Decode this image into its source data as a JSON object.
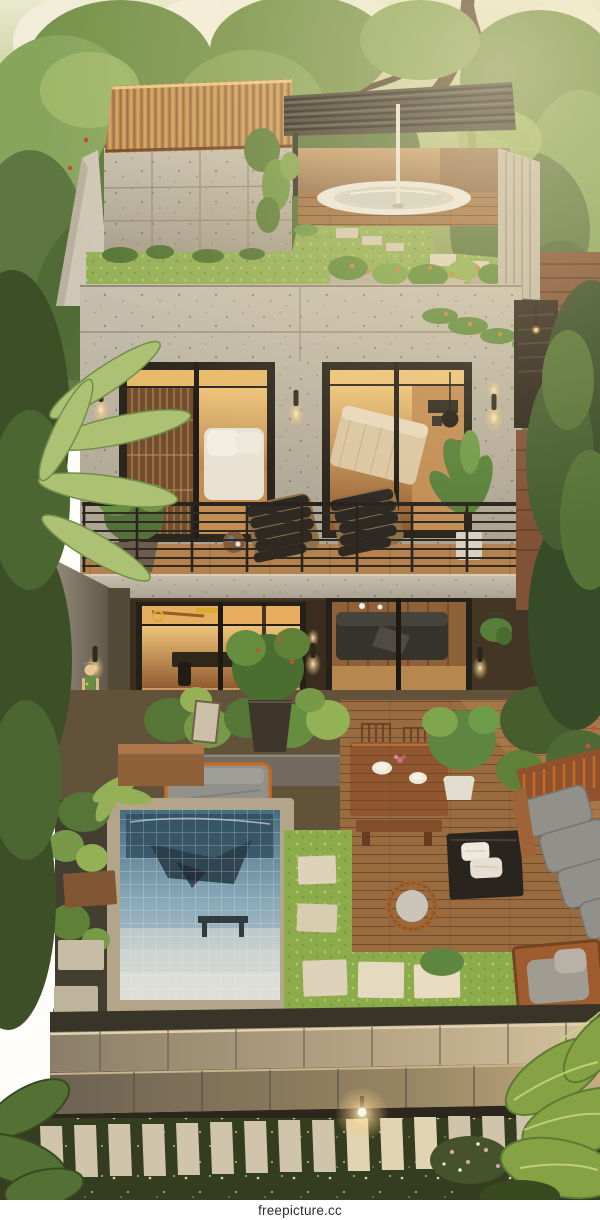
{
  "image": {
    "kind": "3d-architectural-render",
    "subject": "aerial view of a three-level modern concrete house with roof garden, hot tub, balcony, plunge pool and tropical garden at dusk"
  },
  "watermark": {
    "text": "freepicture.cc"
  },
  "palette": {
    "concrete": "#b9b1a2",
    "concrete_light": "#ccc4b4",
    "roof_tile": "#c08a50",
    "pergola": "#3a362f",
    "roof_lawn": "#8fae52",
    "hot_tub": "#ece9e1",
    "wood_deck": "#96643a",
    "wood_warm": "#b27c48",
    "interior_glow": "#e8a95c",
    "window_frame": "#1f1b16",
    "pool_water": "#7fa3b8",
    "pool_deep": "#27455e",
    "grass_bright": "#86a844",
    "lawn_dark": "#2a3318",
    "stone_path": "#cfc4ab",
    "cushion_gray": "#8d8c88",
    "accent_orange": "#c2641e",
    "foliage_dark": "#3d5527",
    "foliage_mid": "#5f7f3a",
    "foliage_light": "#8fae56"
  },
  "scene": {
    "rooftop": [
      "tiled-roof",
      "louvered-pergola",
      "hot-tub",
      "roof-lawn",
      "roof-planters",
      "ivy-vines"
    ],
    "middle-floor": [
      "bedroom-window-left",
      "bedroom-window-right",
      "wall-sconces",
      "balcony-railing",
      "lounge-chairs",
      "balcony-plants"
    ],
    "ground-floor": [
      "dining-room-doors",
      "bedroom-glass-wall",
      "hanging-planters",
      "woman-figure",
      "side-passage-steps"
    ],
    "patio": [
      "outdoor-dining-table",
      "gray-daybed",
      "plunge-pool",
      "grass-pavers",
      "rattan-chair",
      "coffee-table",
      "outdoor-sofa",
      "wood-deck"
    ],
    "garden": [
      "stone-terrace-steps",
      "paver-path",
      "garden-light",
      "flower-lawn",
      "tropical-leaves"
    ]
  }
}
